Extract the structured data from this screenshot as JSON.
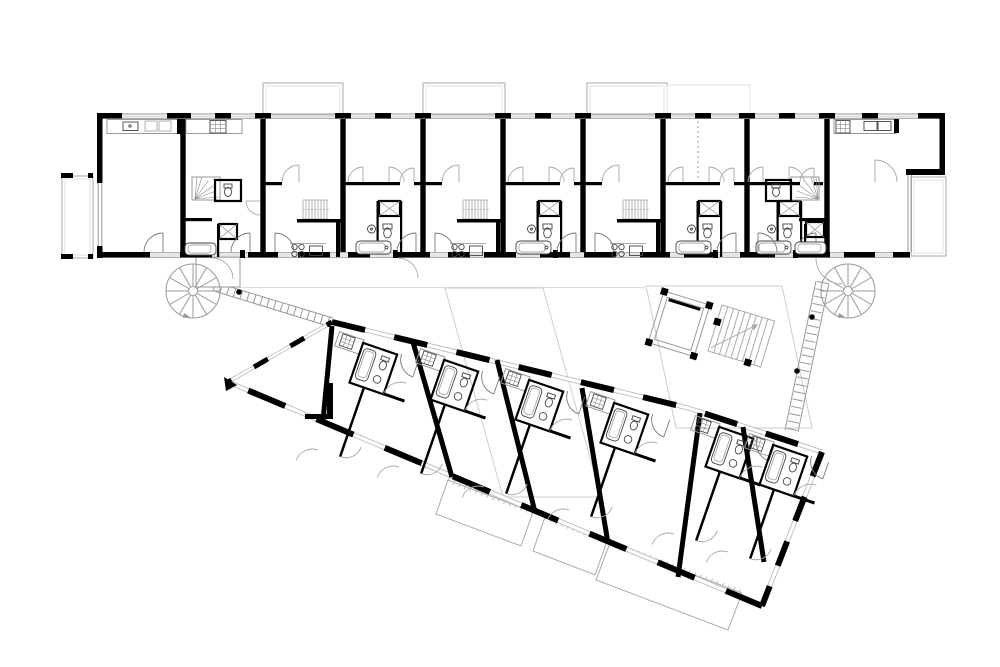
{
  "meta": {
    "title": "Residential floor plan - two apartment wings",
    "description": "Black-and-white architectural upper-floor plan: a straight north wing and a wedge-shaped rotated south wing, linked by external walkways, two spiral staircases, an elevator shaft and a common stair core.",
    "background": "#ffffff"
  },
  "palette": {
    "wall": "#000000",
    "fixture_line": "#444444",
    "light_line": "#999999",
    "lighter_line": "#aaaaaa",
    "faint_line": "#cccccc",
    "paper": "#ffffff"
  },
  "upper_wing": {
    "orientation_deg": 0,
    "units": 8,
    "balconies_north": 4,
    "balcony_west": 1,
    "roof_terrace_east": 1,
    "straight_stairs": 3,
    "winder_stairs": 2,
    "kitchens": 4,
    "bathrooms": 6
  },
  "lower_wing": {
    "orientation_deg": 19,
    "shape": "wedge with pointed west tip",
    "units": 6,
    "terraces_south": 3,
    "bathrooms": 6,
    "kitchens": 6
  },
  "circulation": {
    "spiral_staircases": 2,
    "elevator": 1,
    "core_stair": 1,
    "walkways": 2,
    "column_dots": 3
  },
  "symbols": {
    "wall": "thick black fill",
    "window": "triple thin line strip",
    "door": "quarter-circle swing arc",
    "shower": "square with X",
    "bathtub": "rounded rectangle",
    "stove": "2x2 burner circles or 3x3 checker hob",
    "stair": "hatched treads",
    "spiral_stair": "circle with radial treads"
  }
}
